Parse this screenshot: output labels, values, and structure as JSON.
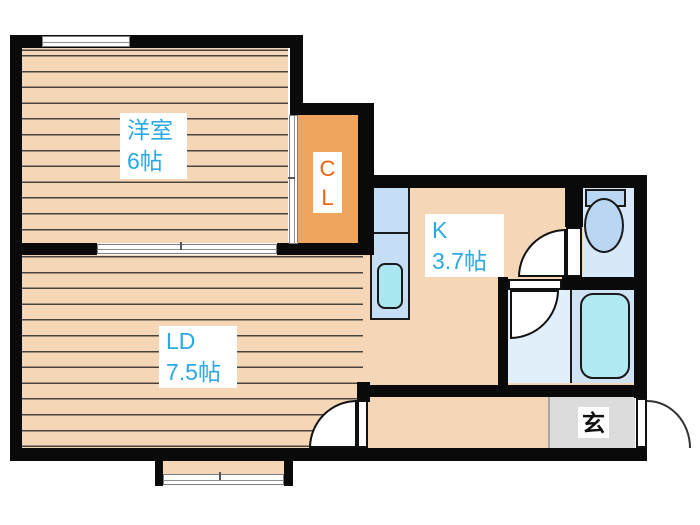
{
  "plan": {
    "rooms": {
      "western_room": {
        "name": "洋室",
        "size": "6帖"
      },
      "living_dining": {
        "name": "LD",
        "size": "7.5帖"
      },
      "kitchen": {
        "name": "K",
        "size": "3.7帖"
      },
      "closet": {
        "line1": "C",
        "line2": "L"
      },
      "entrance": {
        "name": "玄"
      }
    },
    "icons": {
      "toilet": "toilet-icon",
      "bathtub": "bathtub-icon",
      "kitchen_sink": "kitchen-sink-icon",
      "door_swings": "door-swing-arc",
      "windows": "window-symbol"
    },
    "colors": {
      "wall": "#0a0a0a",
      "wood_floor": "#f5d6b6",
      "closet_fill": "#f0a55f",
      "wet_area_fill": "#d7e9f8",
      "fixture_blue": "#b9d6f2",
      "bathtub_fill": "#b2eaf4",
      "entrance_floor": "#dcdcdc",
      "label_blue": "#2aa9e2",
      "label_orange": "#ea6410"
    }
  }
}
